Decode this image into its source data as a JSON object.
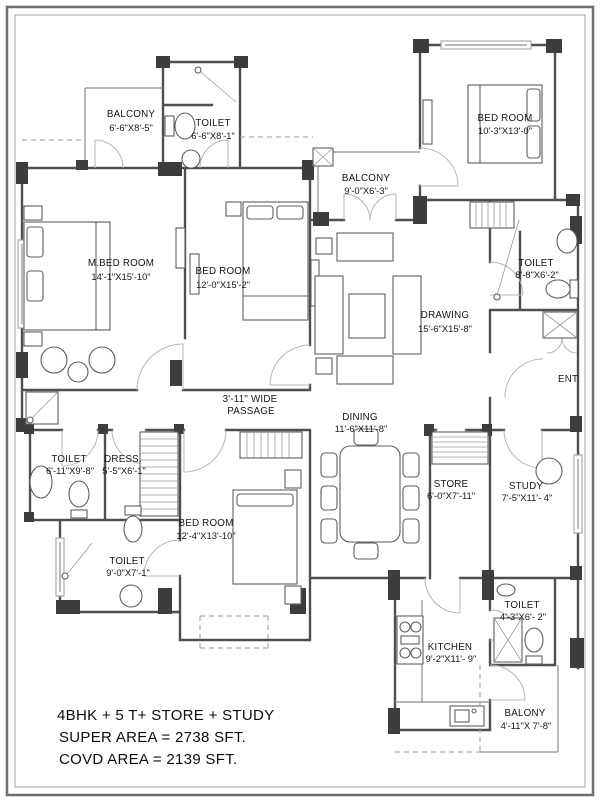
{
  "plan": {
    "rooms": {
      "balcony_tl": {
        "name": "BALCONY",
        "dims": "6'-6\"X8'-5\""
      },
      "toilet_tl": {
        "name": "TOILET",
        "dims": "6'-6\"X8'-1\""
      },
      "bed_tr": {
        "name": "BED ROOM",
        "dims": "10'-3\"X13'-0\""
      },
      "mbed": {
        "name": "M.BED ROOM",
        "dims": "14'-1\"X15'-10\""
      },
      "bed_c": {
        "name": "BED ROOM",
        "dims": "12'-0\"X15'-2\""
      },
      "balcony_c": {
        "name": "BALCONY",
        "dims": "9'-0\"X6'-3\""
      },
      "drawing": {
        "name": "DRAWING",
        "dims": "15'-6\"X15'-8\""
      },
      "toilet_tr": {
        "name": "TOILET",
        "dims": "8'-8\"X6'-2\""
      },
      "dining": {
        "name": "DINING",
        "dims": "11'-6\"X11'-8\""
      },
      "toilet_l": {
        "name": "TOILET",
        "dims": "6'-11\"X9'-8\""
      },
      "dress": {
        "name": "DRESS.",
        "dims": "5'-5\"X6'-1\""
      },
      "bed_b": {
        "name": "BED ROOM",
        "dims": "12'-4\"X13'-10\""
      },
      "store": {
        "name": "STORE",
        "dims": "6'-0\"X7'-11\""
      },
      "study": {
        "name": "STUDY",
        "dims": "7'-5\"X11'- 4\""
      },
      "toilet_bl": {
        "name": "TOILET",
        "dims": "9'-0\"X7'-1\""
      },
      "toilet_br": {
        "name": "TOILET",
        "dims": "4'-3\"X6'- 2\""
      },
      "kitchen": {
        "name": "KITCHEN",
        "dims": "9'-2\"X11'- 9\""
      },
      "balcony_br": {
        "name": "BALONY",
        "dims": "4'-11\"X 7'-8\""
      }
    },
    "annotations": {
      "entrance": "ENT.",
      "passage_line1": "3'-11\" WIDE",
      "passage_line2": "PASSAGE"
    },
    "footer": {
      "line1": "4BHK + 5 T+ STORE + STUDY",
      "line2": "SUPER  AREA = 2738 SFT.",
      "line3": "COVD  AREA = 2139 SFT."
    },
    "colors": {
      "wall": "#4f4f4f",
      "pillar": "#3d3d3d",
      "text": "#161616",
      "background": "#ffffff"
    }
  }
}
